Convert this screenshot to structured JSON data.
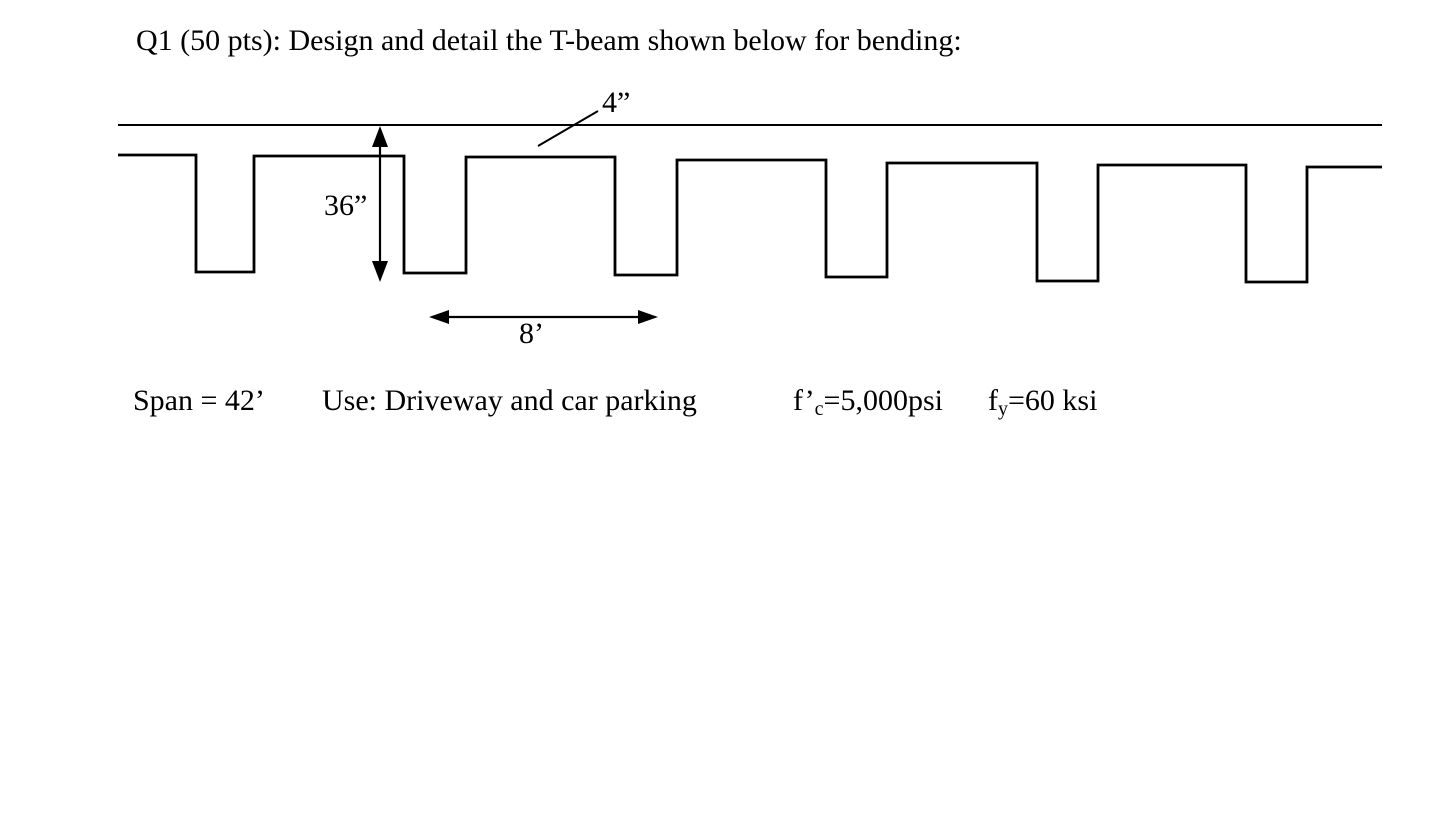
{
  "page": {
    "title": "Q1 (50 pts): Design and detail the T-beam shown below for bending:"
  },
  "diagram": {
    "flange_thickness_label": "4”",
    "depth_label": "36”",
    "spacing_label": "8’"
  },
  "given": {
    "span": "Span = 42’",
    "use": "Use: Driveway and car parking",
    "fc_base": "f’",
    "fc_sub": "c",
    "fc_rest": "=5,000psi",
    "fy_base": "f",
    "fy_sub": "y",
    "fy_rest": "=60 ksi"
  }
}
